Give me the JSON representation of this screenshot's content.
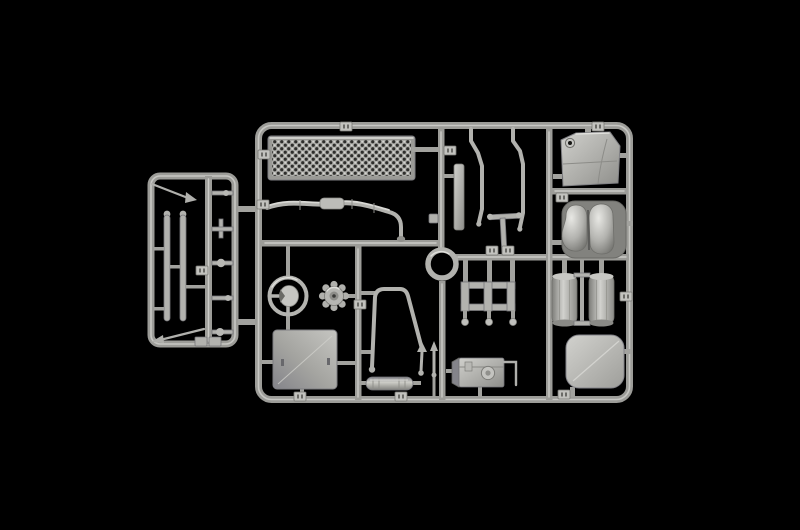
{
  "scene": {
    "description": "Photograph of a light grey injection-moulded plastic model kit sprue (parts runner) laid on a black background; a small secondary runner with thin rods is attached on the left side of the large main runner",
    "subject": "plastic-model-kit-sprue",
    "visible_text": "",
    "background": "#000000"
  },
  "colors": {
    "background": "#000000",
    "plastic_mid": "#a9a9a5",
    "plastic_light": "#d4d4d0",
    "plastic_highlight": "#e6e6e2",
    "plastic_shadow": "#6a6a66",
    "hole_dark": "#2e2e2c"
  },
  "sprues": {
    "left_runner": {
      "name": "small side runner",
      "parts": [
        "thin antenna rod (top, diagonal)",
        "wiper / spring strip (left)",
        "wiper / spring strip (right)",
        "five small linkage rods on centre rail",
        "thin antenna rod (bottom, diagonal)",
        "two small gate blocks"
      ]
    },
    "main_runner": {
      "name": "main parts runner",
      "parts": [
        "perforated grille / walkway plate",
        "segmented exhaust pipe with down elbow",
        "mirror arm rod (left)",
        "mirror arm rod (right)",
        "heat-shield strip",
        "wiper tee part",
        "small bracket",
        "mudguard panel with grommet hole",
        "twin glossy tank shells on flange plate",
        "air tank cylinder (left)",
        "air tank cylinder (right)",
        "tie rod between cylinders",
        "rounded hatch panel",
        "ladder frame bracket with three feet",
        "tow ring (circular part in rail)",
        "steering wheel",
        "fan / pulley wheel",
        "roof panel",
        "seat-back tube frame with dart",
        "silencer muffler",
        "gear lever",
        "battery box with wire handle",
        "numbered gate tabs along rails"
      ]
    }
  }
}
